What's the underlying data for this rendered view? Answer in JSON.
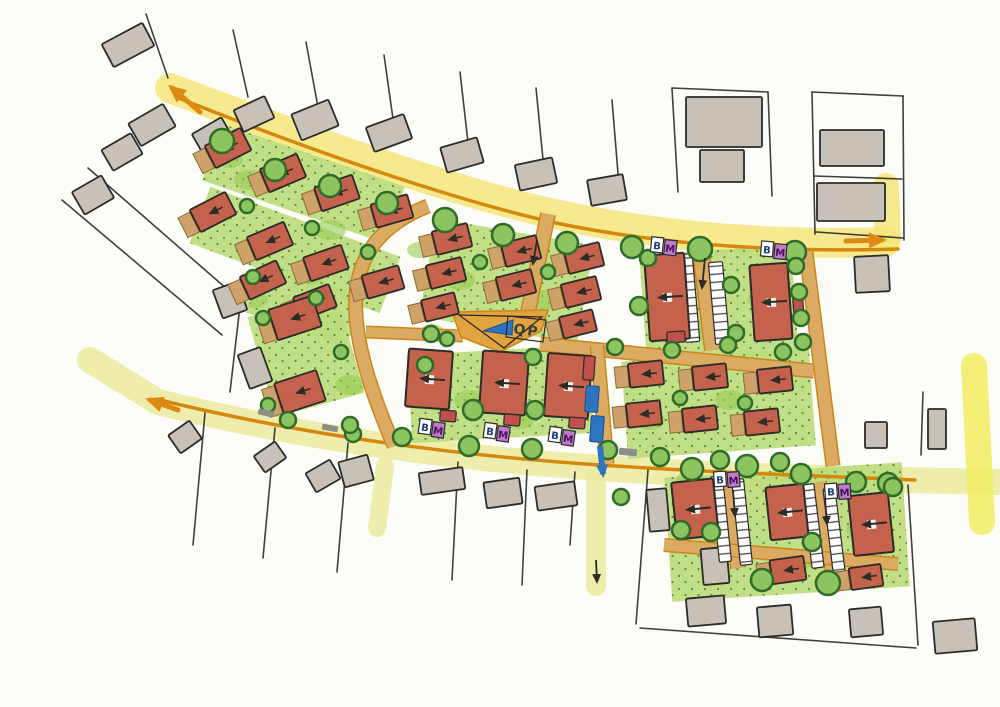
{
  "labels": {
    "plaza_marker": "QP",
    "parking_marker": "B",
    "waste_marker": "M"
  },
  "colors": {
    "paper": "#fdfdf8",
    "ink": "#2b2b28",
    "road_yellow": "#f5e57b",
    "road_yellow_green": "#ecea9e",
    "road_yellow_bright": "#f1ec60",
    "curb_orange": "#d4890e",
    "arrow_orange": "#dd8a12",
    "street_tan": "#dcab63",
    "street_edge": "#c9871c",
    "plaza_tan": "#e2a43e",
    "green_light": "#bcdc7d",
    "green_dark": "#97cb52",
    "green_stipple": "#44701f",
    "tree_fill": "#8cc45f",
    "tree_stroke": "#2f6b2a",
    "building_red": "#c4624c",
    "garage_tan": "#cfa269",
    "garage_edge": "#8a6b3a",
    "context_gray": "#c8c1b8",
    "marker_purple": "#bf7cc9",
    "marker_letter_b": "#1f3d7a",
    "marker_letter_m": "#471061",
    "blue": "#2f74c0",
    "crossing_gray": "#8f8f86",
    "hatch_line": "#4a4a46",
    "red_accent": "#c0504d"
  },
  "map": {
    "roads": [
      {
        "name": "main-road-north",
        "d": "M 170,88 C 320,145 450,190 545,212 C 670,240 790,245 885,242",
        "w": 30,
        "c": "road_yellow"
      },
      {
        "name": "north-road-stub",
        "d": "M 886,186 L 888,240",
        "w": 26,
        "c": "road_yellow"
      },
      {
        "name": "main-road-south",
        "d": "M 90,360 L 158,402 C 300,437 450,458 600,468 C 750,478 900,480 1000,482",
        "w": 26,
        "c": "road_yellow_green"
      },
      {
        "name": "east-cross-road",
        "d": "M 974,366 L 982,522",
        "w": 26,
        "c": "road_yellow_bright"
      },
      {
        "name": "south-access-road",
        "d": "M 596,466 L 596,586",
        "w": 20,
        "c": "road_yellow_green"
      },
      {
        "name": "southwest-road-stub",
        "d": "M 385,466 L 377,528",
        "w": 18,
        "c": "road_yellow_green"
      }
    ],
    "curbs": [
      {
        "d": "M 181,99 C 330,158 462,202 556,223 C 676,248 802,252 898,249",
        "w": 3.5
      },
      {
        "d": "M 160,400 C 300,434 450,455 600,465 C 720,473 820,476 915,480",
        "w": 3.5
      }
    ],
    "green_bands": [
      {
        "d": "M 212,152 L 395,215",
        "w": 60
      },
      {
        "d": "M 200,215 L 390,285",
        "w": 60
      },
      {
        "d": "M 255,287 L 355,322",
        "w": 54
      },
      {
        "d": "M 292,305 L 320,405",
        "w": 92
      },
      {
        "d": "M 515,232 L 498,330",
        "w": 160
      },
      {
        "d": "M 715,250 L 723,360",
        "w": 152
      },
      {
        "d": "M 498,350 L 503,438",
        "w": 182
      },
      {
        "d": "M 715,355 L 722,452",
        "w": 188
      },
      {
        "d": "M 783,470 L 791,594",
        "w": 238
      }
    ],
    "green_blobs": [
      [
        250,
        180,
        16,
        10
      ],
      [
        330,
        230,
        16,
        10
      ],
      [
        295,
        320,
        18,
        11
      ],
      [
        350,
        385,
        15,
        10
      ],
      [
        460,
        280,
        15,
        10
      ],
      [
        545,
        300,
        15,
        10
      ],
      [
        660,
        300,
        16,
        11
      ],
      [
        700,
        330,
        14,
        9
      ],
      [
        470,
        400,
        16,
        10
      ],
      [
        520,
        420,
        14,
        9
      ],
      [
        650,
        420,
        15,
        10
      ],
      [
        730,
        400,
        15,
        10
      ],
      [
        700,
        520,
        16,
        11
      ],
      [
        800,
        560,
        16,
        10
      ],
      [
        860,
        530,
        14,
        9
      ],
      [
        255,
        300,
        13,
        8
      ],
      [
        420,
        250,
        13,
        8
      ],
      [
        760,
        300,
        13,
        8
      ],
      [
        690,
        480,
        14,
        9
      ],
      [
        432,
        332,
        12,
        8
      ],
      [
        230,
        160,
        13,
        8
      ],
      [
        310,
        275,
        14,
        9
      ]
    ],
    "streets": [
      {
        "d": "M 548,214 L 524,332",
        "w": 13
      },
      {
        "d": "M 540,344 L 814,371",
        "w": 12
      },
      {
        "d": "M 806,252 L 833,466",
        "w": 12
      },
      {
        "d": "M 597,346 L 607,464",
        "w": 12
      },
      {
        "d": "M 428,206 C 330,245 345,330 394,446",
        "w": 12
      },
      {
        "d": "M 366,332 L 463,336",
        "w": 10
      },
      {
        "d": "M 700,244 L 713,350",
        "w": 15
      },
      {
        "d": "M 727,474 L 738,568",
        "w": 13
      },
      {
        "d": "M 819,482 L 833,573",
        "w": 13
      },
      {
        "d": "M 664,545 L 898,564",
        "w": 11
      }
    ],
    "plaza": {
      "pts": "452,312 548,310 541,331 500,352 461,337",
      "outline_pts": "459,315 542,317 504,348",
      "box_pts": "508,316 546,320 543,342 506,337",
      "arrow_pts": "483,331 513,320 512,335",
      "label_x": 526,
      "label_y": 335,
      "label_rot": 7
    },
    "context_lines": [
      [
        146,
        14,
        168,
        78
      ],
      [
        233,
        30,
        248,
        97
      ],
      [
        306,
        42,
        320,
        118
      ],
      [
        384,
        55,
        396,
        140
      ],
      [
        460,
        72,
        470,
        160
      ],
      [
        536,
        88,
        545,
        180
      ],
      [
        612,
        100,
        620,
        198
      ],
      [
        672,
        88,
        678,
        192
      ],
      [
        768,
        92,
        772,
        196
      ],
      [
        672,
        88,
        768,
        92
      ],
      [
        812,
        92,
        815,
        234
      ],
      [
        903,
        96,
        904,
        240
      ],
      [
        812,
        92,
        903,
        96
      ],
      [
        814,
        176,
        902,
        179
      ],
      [
        816,
        232,
        903,
        238
      ],
      [
        88,
        168,
        243,
        303
      ],
      [
        62,
        200,
        222,
        335
      ],
      [
        240,
        306,
        230,
        392
      ],
      [
        205,
        413,
        193,
        545
      ],
      [
        275,
        428,
        263,
        558
      ],
      [
        348,
        443,
        337,
        572
      ],
      [
        458,
        462,
        452,
        580
      ],
      [
        527,
        470,
        522,
        585
      ],
      [
        648,
        470,
        636,
        624
      ],
      [
        908,
        485,
        918,
        645
      ],
      [
        640,
        628,
        916,
        648
      ],
      [
        923,
        392,
        921,
        455
      ],
      [
        575,
        472,
        570,
        545
      ]
    ],
    "context_buildings": [
      [
        128,
        45,
        46,
        26,
        -28
      ],
      [
        152,
        125,
        40,
        26,
        -30
      ],
      [
        122,
        152,
        34,
        24,
        -30
      ],
      [
        93,
        195,
        34,
        26,
        -30
      ],
      [
        213,
        137,
        34,
        26,
        -30
      ],
      [
        254,
        114,
        34,
        24,
        -25
      ],
      [
        315,
        120,
        40,
        28,
        -22
      ],
      [
        389,
        133,
        40,
        26,
        -20
      ],
      [
        462,
        155,
        38,
        26,
        -16
      ],
      [
        536,
        174,
        38,
        26,
        -12
      ],
      [
        607,
        190,
        36,
        26,
        -10
      ],
      [
        724,
        122,
        76,
        50,
        0
      ],
      [
        722,
        166,
        44,
        32,
        0
      ],
      [
        852,
        148,
        64,
        36,
        0
      ],
      [
        851,
        202,
        68,
        38,
        0
      ],
      [
        872,
        274,
        34,
        36,
        -3
      ],
      [
        230,
        300,
        26,
        30,
        -20
      ],
      [
        255,
        368,
        24,
        36,
        -20
      ],
      [
        185,
        437,
        26,
        22,
        -35
      ],
      [
        270,
        457,
        26,
        20,
        -35
      ],
      [
        323,
        476,
        28,
        22,
        -30
      ],
      [
        356,
        471,
        30,
        26,
        -15
      ],
      [
        442,
        481,
        44,
        22,
        -8
      ],
      [
        503,
        493,
        36,
        26,
        -8
      ],
      [
        556,
        496,
        40,
        24,
        -8
      ],
      [
        658,
        510,
        20,
        42,
        -5
      ],
      [
        715,
        566,
        26,
        36,
        -5
      ],
      [
        706,
        611,
        38,
        28,
        -5
      ],
      [
        775,
        621,
        34,
        30,
        -5
      ],
      [
        866,
        622,
        32,
        28,
        -5
      ],
      [
        955,
        636,
        42,
        32,
        -5
      ],
      [
        876,
        435,
        22,
        26,
        0
      ],
      [
        937,
        429,
        18,
        40,
        0
      ]
    ],
    "parking_strips": [
      [
        689,
        298,
        14,
        88,
        -5
      ],
      [
        719,
        303,
        14,
        82,
        -5
      ],
      [
        721,
        519,
        12,
        86,
        -6
      ],
      [
        742,
        522,
        12,
        86,
        -6
      ],
      [
        813,
        526,
        12,
        84,
        -7
      ],
      [
        834,
        530,
        12,
        84,
        -7
      ]
    ],
    "houses": [
      [
        228,
        148,
        40,
        25,
        -27
      ],
      [
        283,
        173,
        40,
        25,
        -23
      ],
      [
        337,
        193,
        40,
        25,
        -19
      ],
      [
        392,
        211,
        38,
        24,
        -16
      ],
      [
        213,
        212,
        40,
        25,
        -27
      ],
      [
        270,
        241,
        40,
        25,
        -23
      ],
      [
        326,
        263,
        40,
        25,
        -19
      ],
      [
        383,
        282,
        38,
        24,
        -16
      ],
      [
        263,
        280,
        40,
        25,
        -25
      ],
      [
        315,
        302,
        38,
        24,
        -21
      ],
      [
        295,
        318,
        46,
        32,
        -18
      ],
      [
        300,
        392,
        44,
        32,
        -18
      ],
      [
        452,
        239,
        36,
        24,
        -14
      ],
      [
        446,
        273,
        36,
        24,
        -14
      ],
      [
        440,
        307,
        34,
        22,
        -14
      ],
      [
        521,
        251,
        36,
        24,
        -14
      ],
      [
        516,
        285,
        36,
        24,
        -14
      ],
      [
        584,
        258,
        36,
        24,
        -14
      ],
      [
        581,
        292,
        36,
        24,
        -14
      ],
      [
        578,
        324,
        34,
        22,
        -14
      ],
      [
        646,
        374,
        34,
        24,
        -6
      ],
      [
        710,
        377,
        34,
        24,
        -6
      ],
      [
        775,
        380,
        34,
        24,
        -6
      ],
      [
        644,
        414,
        34,
        24,
        -6
      ],
      [
        700,
        419,
        34,
        24,
        -6
      ],
      [
        762,
        422,
        34,
        24,
        -6
      ],
      [
        788,
        570,
        34,
        24,
        -8
      ],
      [
        866,
        577,
        32,
        22,
        -8
      ]
    ],
    "large_buildings": [
      [
        667,
        297,
        40,
        86,
        -4
      ],
      [
        771,
        302,
        38,
        76,
        -4
      ],
      [
        429,
        379,
        44,
        58,
        4
      ],
      [
        504,
        383,
        46,
        62,
        4
      ],
      [
        568,
        386,
        44,
        63,
        4
      ],
      [
        695,
        509,
        42,
        57,
        -6
      ],
      [
        787,
        512,
        38,
        53,
        -6
      ],
      [
        871,
        524,
        40,
        60,
        -6
      ]
    ],
    "red_accents": [
      [
        448,
        416,
        16,
        11,
        4
      ],
      [
        512,
        420,
        16,
        11,
        4
      ],
      [
        577,
        423,
        16,
        11,
        4
      ],
      [
        676,
        337,
        18,
        11,
        -4
      ],
      [
        798,
        302,
        10,
        28,
        -4
      ],
      [
        589,
        368,
        11,
        24,
        4
      ]
    ],
    "trees": [
      [
        222,
        141,
        12
      ],
      [
        275,
        170,
        11
      ],
      [
        330,
        186,
        11
      ],
      [
        387,
        203,
        11
      ],
      [
        445,
        220,
        12
      ],
      [
        503,
        235,
        11
      ],
      [
        567,
        243,
        11
      ],
      [
        632,
        247,
        11
      ],
      [
        700,
        249,
        12
      ],
      [
        795,
        252,
        11
      ],
      [
        796,
        266,
        8
      ],
      [
        799,
        292,
        8
      ],
      [
        801,
        318,
        8
      ],
      [
        803,
        342,
        8
      ],
      [
        731,
        285,
        8
      ],
      [
        736,
        333,
        8
      ],
      [
        639,
        306,
        9
      ],
      [
        648,
        258,
        8
      ],
      [
        431,
        334,
        8
      ],
      [
        447,
        339,
        7
      ],
      [
        533,
        357,
        8
      ],
      [
        615,
        347,
        8
      ],
      [
        672,
        350,
        8
      ],
      [
        728,
        345,
        8
      ],
      [
        783,
        352,
        8
      ],
      [
        473,
        410,
        10
      ],
      [
        535,
        410,
        9
      ],
      [
        425,
        365,
        8
      ],
      [
        288,
        420,
        8
      ],
      [
        353,
        434,
        8
      ],
      [
        402,
        437,
        9
      ],
      [
        469,
        446,
        10
      ],
      [
        532,
        449,
        10
      ],
      [
        608,
        450,
        9
      ],
      [
        660,
        457,
        9
      ],
      [
        720,
        460,
        9
      ],
      [
        780,
        462,
        9
      ],
      [
        888,
        483,
        10
      ],
      [
        680,
        398,
        7
      ],
      [
        745,
        403,
        7
      ],
      [
        247,
        206,
        7
      ],
      [
        312,
        228,
        7
      ],
      [
        368,
        252,
        7
      ],
      [
        253,
        277,
        7
      ],
      [
        316,
        298,
        7
      ],
      [
        263,
        318,
        7
      ],
      [
        341,
        352,
        7
      ],
      [
        268,
        405,
        7
      ],
      [
        350,
        425,
        8
      ],
      [
        480,
        262,
        7
      ],
      [
        548,
        272,
        7
      ],
      [
        692,
        469,
        11
      ],
      [
        747,
        466,
        11
      ],
      [
        801,
        474,
        10
      ],
      [
        856,
        482,
        10
      ],
      [
        893,
        487,
        9
      ],
      [
        681,
        530,
        9
      ],
      [
        711,
        532,
        9
      ],
      [
        812,
        542,
        9
      ],
      [
        762,
        580,
        11
      ],
      [
        828,
        583,
        12
      ],
      [
        621,
        497,
        8
      ]
    ],
    "bm_markers": [
      [
        432,
        428,
        8
      ],
      [
        497,
        432,
        8
      ],
      [
        562,
        436,
        8
      ],
      [
        664,
        246,
        6
      ],
      [
        774,
        250,
        5
      ],
      [
        727,
        479,
        -4
      ],
      [
        838,
        491,
        -4
      ]
    ],
    "road_arrows": [
      [
        200,
        112,
        172,
        88,
        5
      ],
      [
        846,
        241,
        882,
        240,
        5
      ],
      [
        178,
        410,
        150,
        400,
        5
      ]
    ],
    "lane_arrows": [
      [
        705,
        258,
        702,
        288
      ],
      [
        733,
        490,
        735,
        516
      ],
      [
        825,
        498,
        827,
        524
      ],
      [
        537,
        240,
        533,
        264
      ],
      [
        596,
        560,
        597,
        582
      ]
    ],
    "crossing_dashes": [
      [
        266,
        413,
        16,
        6,
        13
      ],
      [
        330,
        428,
        16,
        6,
        11
      ],
      [
        628,
        452,
        18,
        7,
        5
      ]
    ],
    "blue_route": {
      "rects": [
        [
          592,
          399,
          13,
          26,
          4
        ],
        [
          597,
          429,
          13,
          26,
          4
        ]
      ],
      "arrow": [
        600,
        446,
        603,
        474
      ]
    }
  }
}
